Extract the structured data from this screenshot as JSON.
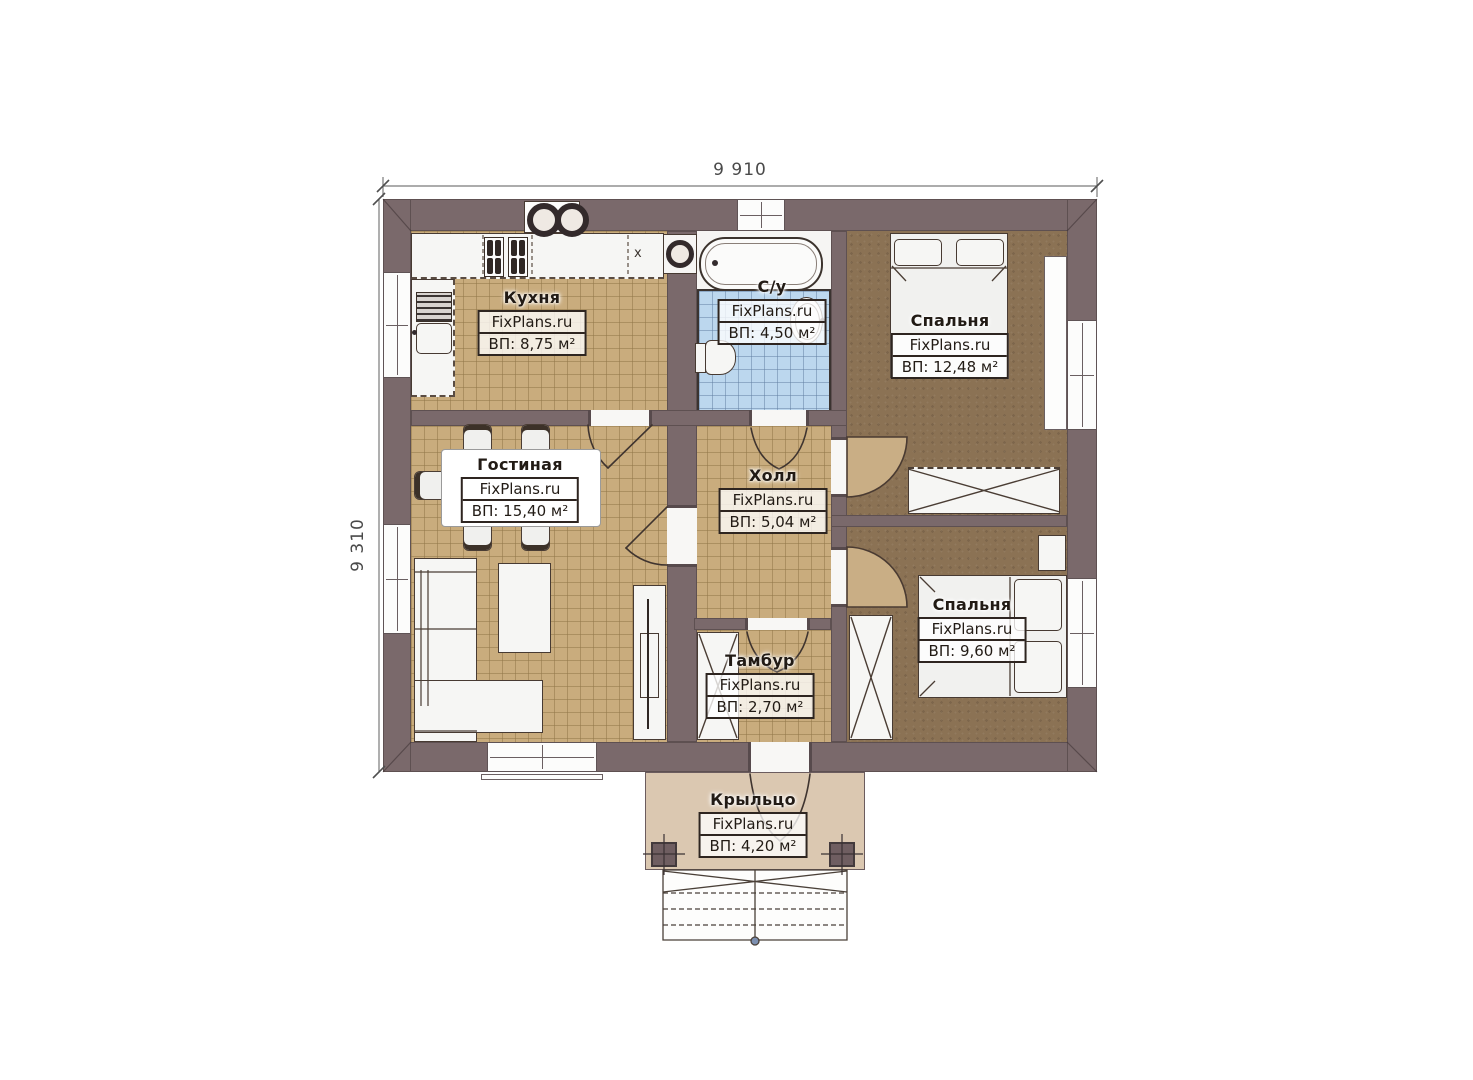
{
  "branding": "FixPlans.ru",
  "dimensions": {
    "width": "9 910",
    "height": "9 310"
  },
  "rooms": [
    {
      "id": "kitchen",
      "name": "Кухня",
      "area": "ВП: 8,75 м²"
    },
    {
      "id": "bathroom",
      "name": "С/у",
      "area": "ВП: 4,50 м²"
    },
    {
      "id": "bedroom1",
      "name": "Спальня",
      "area": "ВП: 12,48 м²"
    },
    {
      "id": "living",
      "name": "Гостиная",
      "area": "ВП: 15,40 м²"
    },
    {
      "id": "hall",
      "name": "Холл",
      "area": "ВП: 5,04 м²"
    },
    {
      "id": "bedroom2",
      "name": "Спальня",
      "area": "ВП: 9,60 м²"
    },
    {
      "id": "tambour",
      "name": "Тамбур",
      "area": "ВП: 2,70 м²"
    },
    {
      "id": "porch",
      "name": "Крыльцо",
      "area": "ВП: 4,20 м²"
    }
  ],
  "markers": {
    "counter_x": "x"
  },
  "colors": {
    "wall": "#7a696b",
    "floor_tan": "#c9ac7d",
    "floor_blue": "#bcd7ee",
    "floor_brown": "#8b7254",
    "porch": "#dbc8b1",
    "door_fan": "#c9ae85"
  }
}
